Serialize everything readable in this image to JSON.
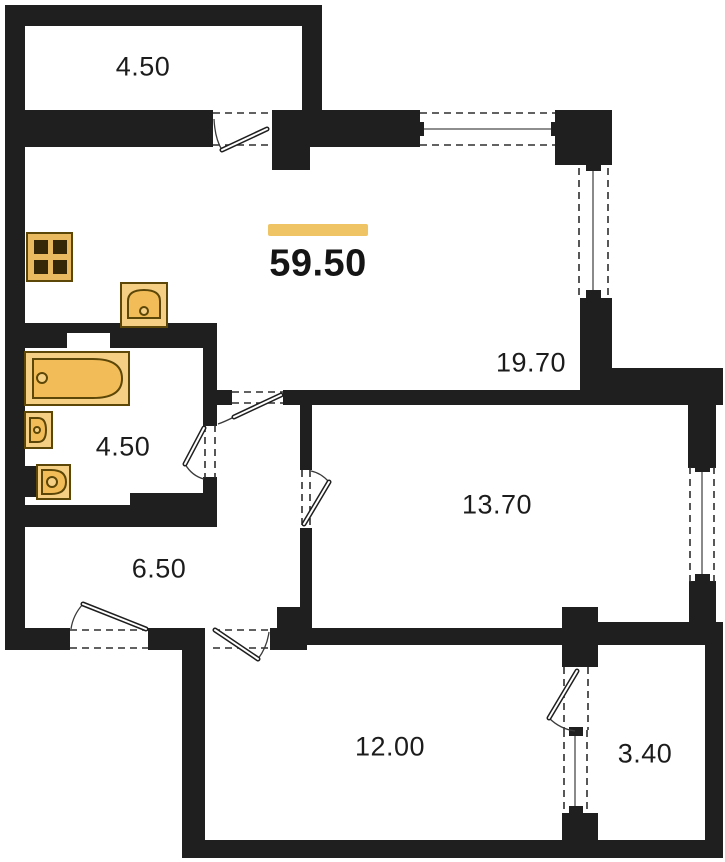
{
  "plan": {
    "type": "apartment-floor-plan",
    "total": {
      "area_label": "59.50"
    },
    "rooms": [
      {
        "id": "balcony-top",
        "area_label": "4.50"
      },
      {
        "id": "living-kitchen",
        "area_label": "19.70"
      },
      {
        "id": "bathroom",
        "area_label": "4.50"
      },
      {
        "id": "bedroom",
        "area_label": "13.70"
      },
      {
        "id": "hallway",
        "area_label": "6.50"
      },
      {
        "id": "bedroom-2",
        "area_label": "12.00"
      },
      {
        "id": "balcony-bottom",
        "area_label": "3.40"
      }
    ],
    "fixtures": [
      "stove",
      "kitchen-sink",
      "bathtub",
      "wash-basin",
      "toilet"
    ],
    "colors": {
      "wall": "#1f1f1f",
      "accent_bar": "#eec465",
      "fixture_fill": "#f2bd58",
      "fixture_fill_light": "#f5d084",
      "fixture_stroke": "#5d4708",
      "background": "#ffffff"
    }
  }
}
